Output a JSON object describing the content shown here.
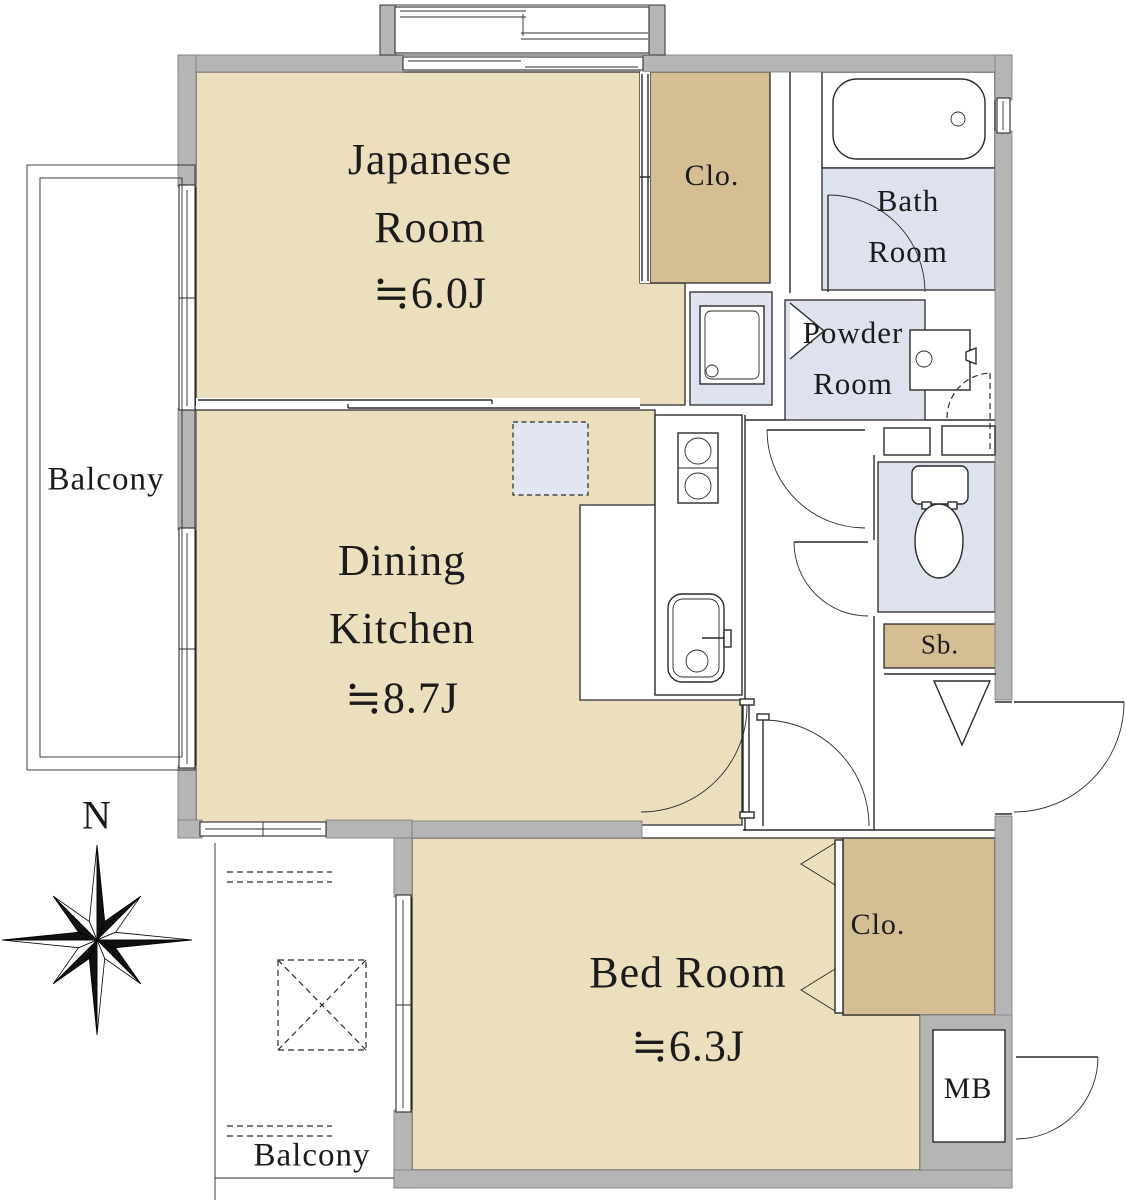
{
  "colors": {
    "room_fill": "#EBDFBD",
    "closet_fill": "#D5BE94",
    "wet_fill": "#DEE2EE",
    "wall_fill": "#B5B5B5",
    "line": "#2B2B2B",
    "text": "#1B1B1B"
  },
  "labels": {
    "japanese_room": {
      "name": "Japanese Room",
      "size": "≒6.0J"
    },
    "dining_kitchen": {
      "name": "Dining Kitchen",
      "size": "≒8.7J"
    },
    "bed_room": {
      "name": "Bed Room",
      "size": "≒6.3J"
    },
    "bath_room": {
      "name": "Bath Room"
    },
    "powder_room": {
      "name": "Powder Room"
    },
    "closet_top": {
      "name": "Clo."
    },
    "closet_bedroom": {
      "name": "Clo."
    },
    "shoe_box": {
      "name": "Sb."
    },
    "meter_box": {
      "name": "MB"
    },
    "balcony_left": {
      "name": "Balcony"
    },
    "balcony_bottom": {
      "name": "Balcony"
    },
    "compass_north": {
      "name": "N"
    }
  }
}
